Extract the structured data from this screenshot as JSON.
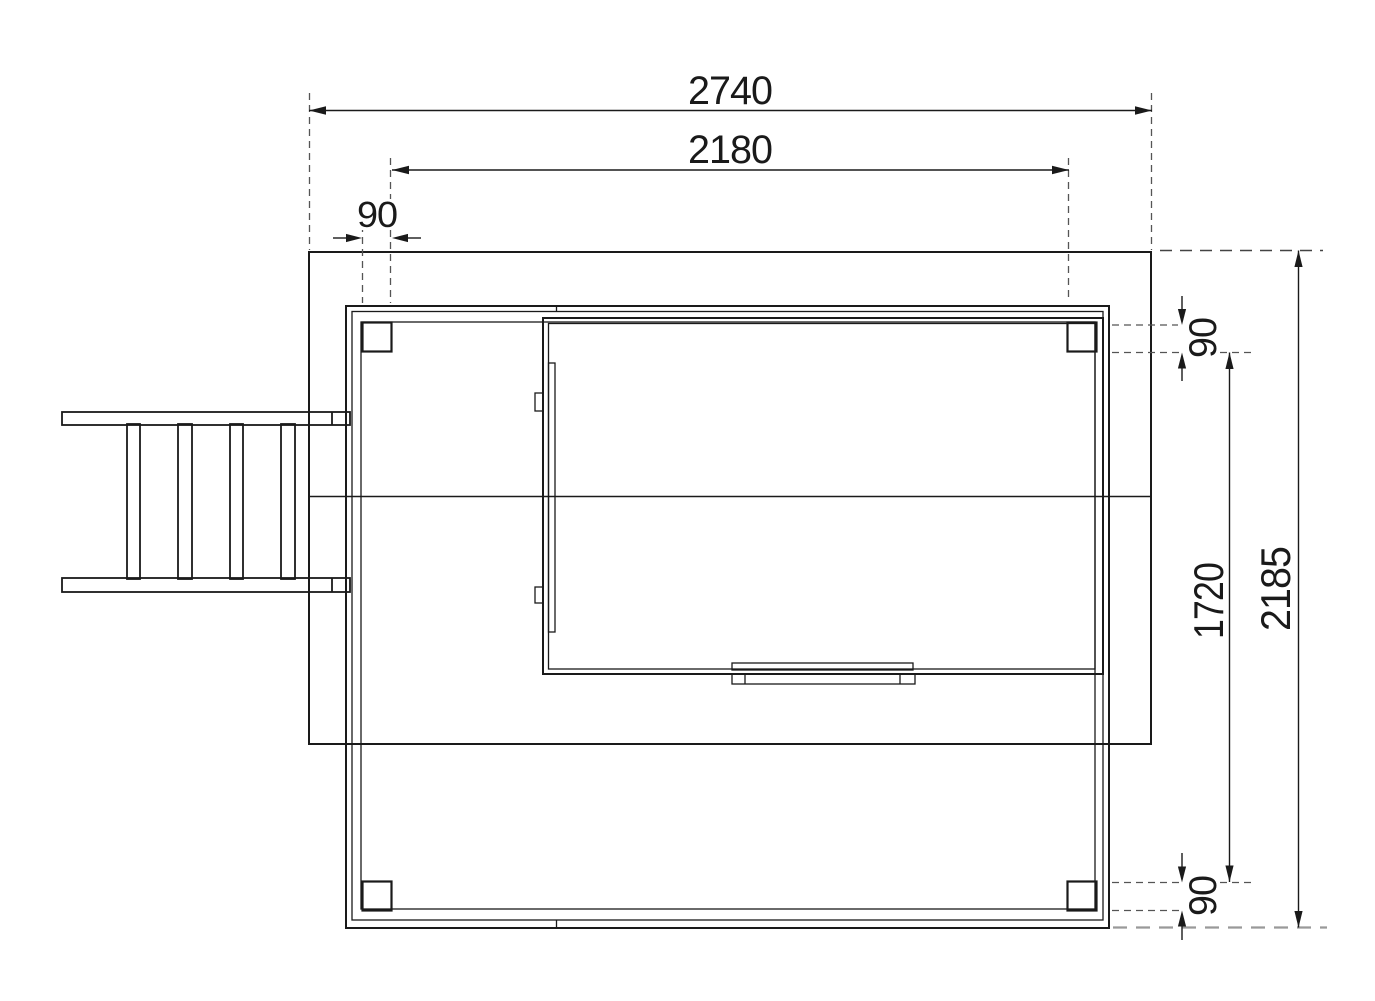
{
  "dimensions": {
    "total_width": "2740",
    "frame_width": "2180",
    "post_width": "90",
    "post_depth_top": "90",
    "post_depth_bottom": "90",
    "frame_depth": "1720",
    "total_depth": "2185"
  },
  "colors": {
    "line": "#1a1a1a",
    "post_fill": "#7f7f7f",
    "dash": "#555555",
    "light_dash": "#999999",
    "background": "#ffffff"
  }
}
